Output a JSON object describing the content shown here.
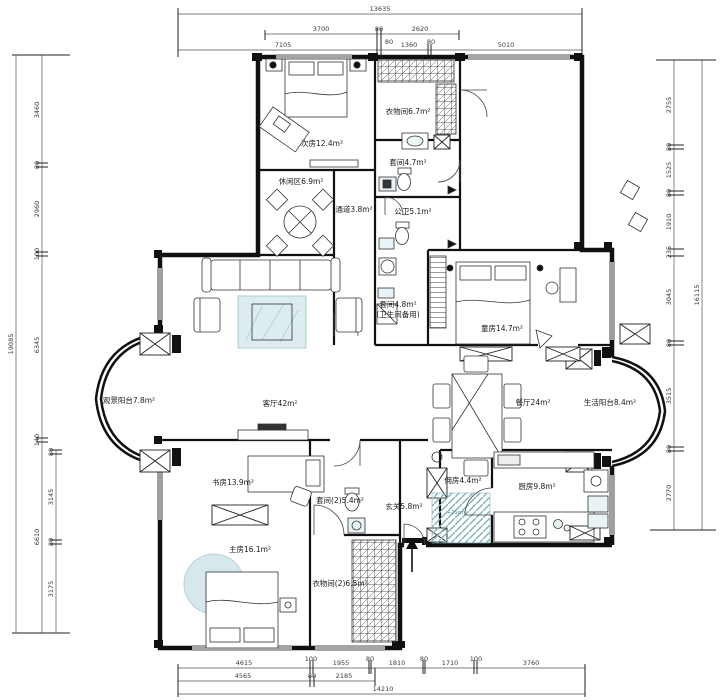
{
  "rooms": [
    {
      "id": "cifang",
      "label": "次房12.4m²"
    },
    {
      "id": "yiwujian1",
      "label": "衣物间6.7m²"
    },
    {
      "id": "taojian1",
      "label": "套间4.7m²"
    },
    {
      "id": "xiuxianqu",
      "label": "休闲区6.9m²"
    },
    {
      "id": "tongdao",
      "label": "通道3.8m²"
    },
    {
      "id": "gongwei",
      "label": "公卫5.1m²"
    },
    {
      "id": "taojian-beiyong",
      "label": "套间4.8m²",
      "sublabel": "(卫生间备用)"
    },
    {
      "id": "tongfang",
      "label": "童房14.7m²"
    },
    {
      "id": "guanjing-yangtai",
      "label": "观景阳台7.8m²"
    },
    {
      "id": "keting",
      "label": "客厅42m²"
    },
    {
      "id": "canting",
      "label": "餐厅24m²"
    },
    {
      "id": "shenghuo-yangtai",
      "label": "生活阳台8.4m²"
    },
    {
      "id": "shufang",
      "label": "书房13.9m²"
    },
    {
      "id": "taojian2",
      "label": "套间(2)5.4m²"
    },
    {
      "id": "xuanguan",
      "label": "玄关5.8m²"
    },
    {
      "id": "yongfang",
      "label": "佣房4.4m²"
    },
    {
      "id": "chufang",
      "label": "厨房9.8m²"
    },
    {
      "id": "zhufang",
      "label": "主房16.1m²"
    },
    {
      "id": "yiwujian2",
      "label": "衣物间(2)6.5m²"
    }
  ],
  "annotations": {
    "step_height": "+25cm"
  },
  "dims": {
    "top1": [
      "13635"
    ],
    "top2": [
      "3700",
      "80",
      "2620"
    ],
    "top3": [
      "7105",
      "80",
      "1360",
      "80",
      "5010"
    ],
    "bottom1": [
      "4615",
      "100",
      "1955",
      "80",
      "1810",
      "80",
      "1710",
      "100",
      "3760"
    ],
    "bottom2": [
      "4565",
      "80",
      "2185"
    ],
    "bottom3": [
      "14210"
    ],
    "left_outer": [
      "19085"
    ],
    "left_mid": [
      "3460",
      "80",
      "2960",
      "100",
      "6345",
      "140",
      "6610"
    ],
    "left_inner": [
      "80",
      "3145",
      "80",
      "3175"
    ],
    "right_inner": [
      "2755",
      "80",
      "1525",
      "80",
      "1910",
      "235",
      "3045",
      "80",
      "3515",
      "80",
      "2770"
    ],
    "right_outer": [
      "16115"
    ]
  },
  "colors": {
    "wall": "#111111",
    "dimline": "#555555",
    "rug": "#dcecef",
    "teal": "#7fb3ba"
  }
}
